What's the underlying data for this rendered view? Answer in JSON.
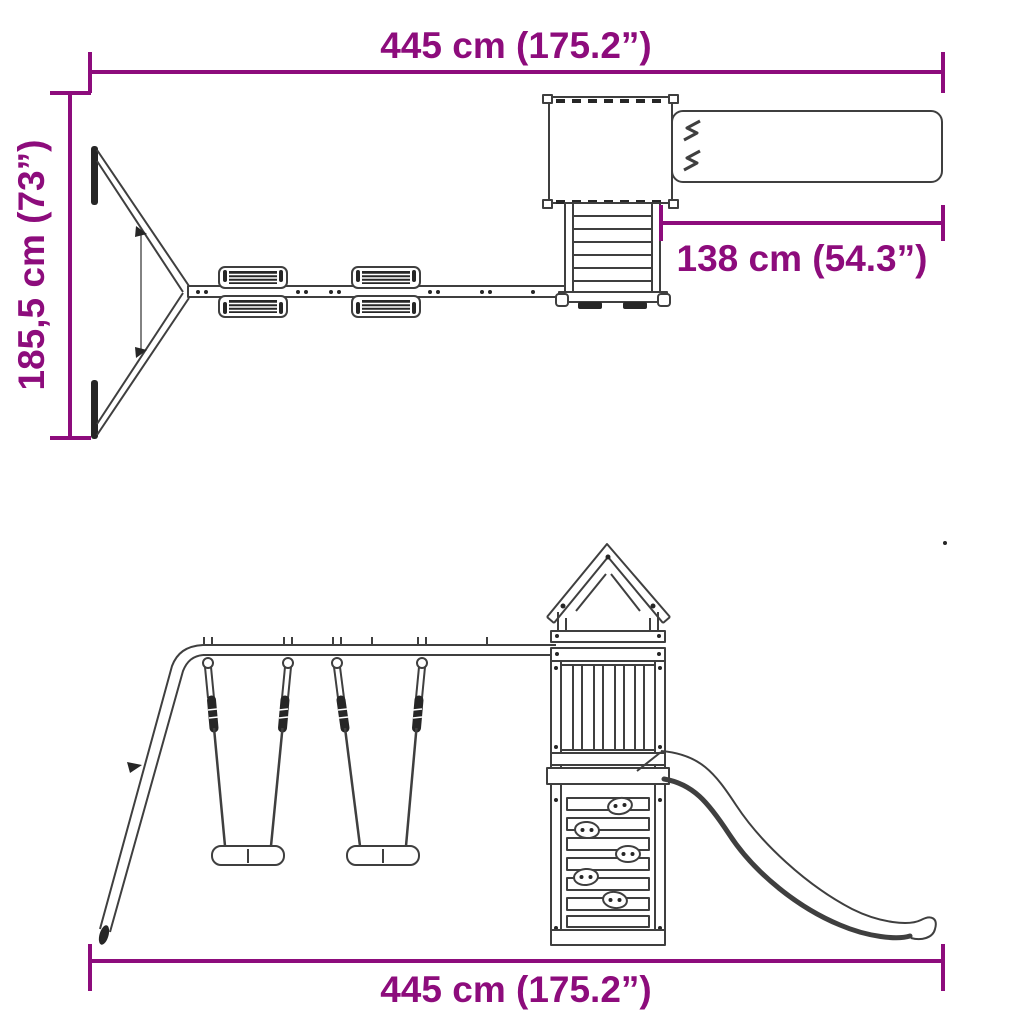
{
  "colors": {
    "dimension_accent": "#8D0C7C",
    "drawing_line": "#3f3f3f",
    "dark_fill": "#262626",
    "background": "#ffffff"
  },
  "views": {
    "top_view": {
      "dimensions": {
        "width": "445 cm (175.2”)",
        "depth": "185,5 cm (73”)",
        "slide_extension": "138 cm (54.3”)"
      }
    },
    "side_view": {
      "dimensions": {
        "width": "445 cm (175.2”)"
      }
    }
  }
}
